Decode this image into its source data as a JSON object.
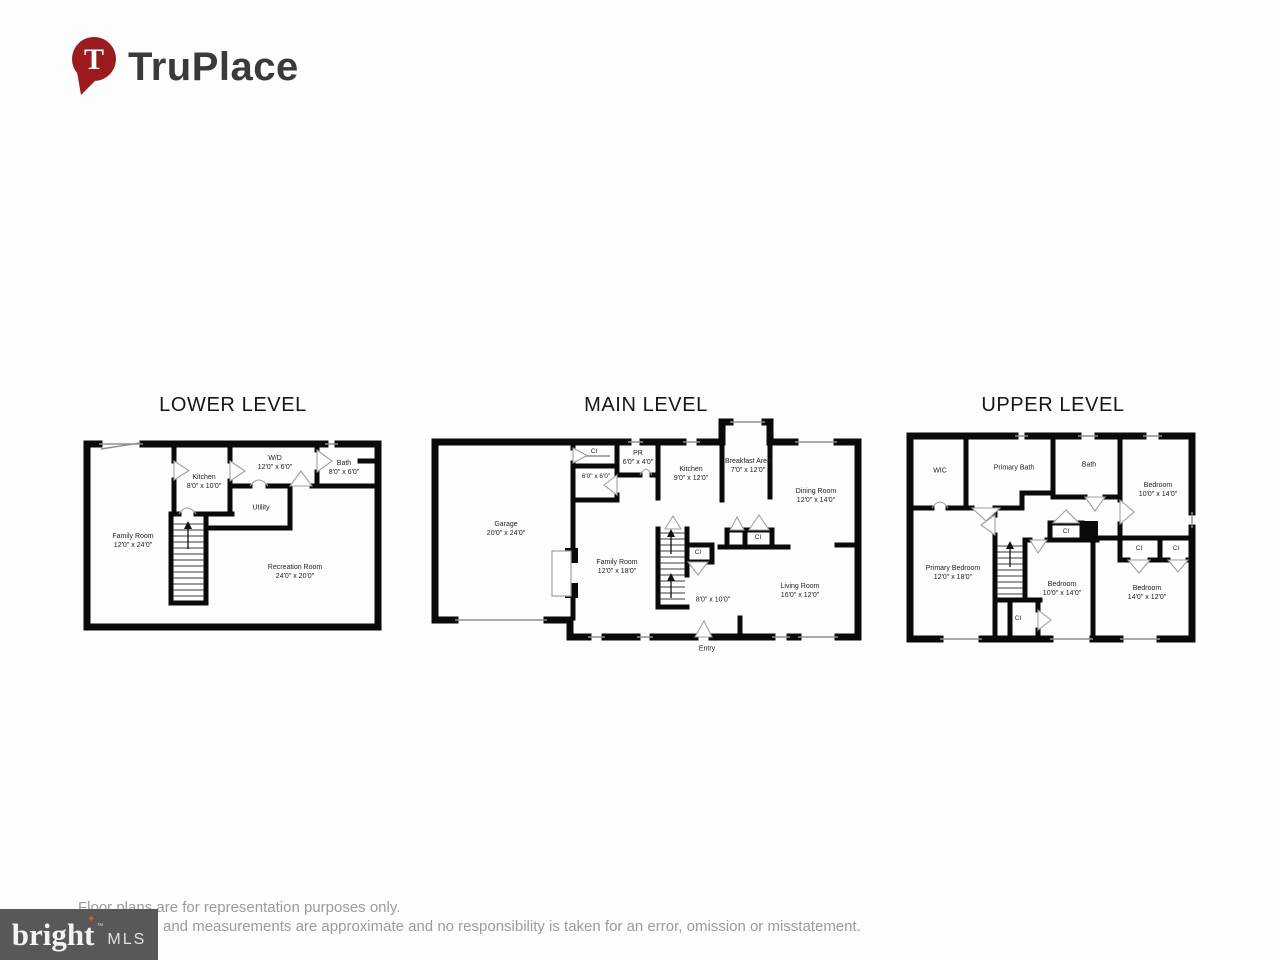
{
  "brand": {
    "name": "TruPlace",
    "pin_letter": "T"
  },
  "plans": {
    "lower": {
      "title": "LOWER LEVEL",
      "rooms": {
        "family": {
          "name": "Family Room",
          "dims": "12'0\" x 24'0\""
        },
        "kitchen": {
          "name": "Kitchen",
          "dims": "8'0\" x 10'0\""
        },
        "wd": {
          "name": "W/D",
          "dims": "12'0\" x 6'0\""
        },
        "bath": {
          "name": "Bath",
          "dims": "8'0\" x 6'0\""
        },
        "utility": {
          "name": "Utility"
        },
        "recreation": {
          "name": "Recreation Room",
          "dims": "24'0\" x 20'0\""
        }
      }
    },
    "main": {
      "title": "MAIN LEVEL",
      "rooms": {
        "garage": {
          "name": "Garage",
          "dims": "20'0\" x 24'0\""
        },
        "closet_top": {
          "name": "CI"
        },
        "mudroom": {
          "dims": "6'0\" x 6'0\""
        },
        "powder": {
          "name": "PR",
          "dims": "6'0\" x 4'0\""
        },
        "kitchen": {
          "name": "Kitchen",
          "dims": "9'0\" x 12'0\""
        },
        "breakfast": {
          "name": "Breakfast Area",
          "dims": "7'0\" x 12'0\""
        },
        "dining": {
          "name": "Dining Room",
          "dims": "12'0\" x 14'0\""
        },
        "family": {
          "name": "Family Room",
          "dims": "12'0\" x 18'0\""
        },
        "stairs": {
          "dims": "8'0\" x 10'0\""
        },
        "closet_stairs": {
          "name": "CI"
        },
        "closet_hall": {
          "name": "CI"
        },
        "living": {
          "name": "Living Room",
          "dims": "16'0\" x 12'0\""
        },
        "entry": {
          "name": "Entry"
        }
      }
    },
    "upper": {
      "title": "UPPER LEVEL",
      "rooms": {
        "wic": {
          "name": "WIC"
        },
        "primary_bath": {
          "name": "Primary Bath"
        },
        "bath": {
          "name": "Bath"
        },
        "bedroom_tr": {
          "name": "Bedroom",
          "dims": "10'0\" x 14'0\""
        },
        "primary_bedroom": {
          "name": "Primary Bedroom",
          "dims": "12'0\" x 18'0\""
        },
        "bedroom_mid": {
          "name": "Bedroom",
          "dims": "10'0\" x 14'0\""
        },
        "bedroom_br": {
          "name": "Bedroom",
          "dims": "14'0\" x 12'0\""
        },
        "closet_hall": {
          "name": "CI"
        },
        "closet_tr1": {
          "name": "CI"
        },
        "closet_tr2": {
          "name": "CI"
        },
        "closet_stairs": {
          "name": "CI"
        }
      }
    }
  },
  "footer": {
    "line1": "Floor plans are for representation purposes only.",
    "line2": "and measurements are approximate and no responsibility is taken for an error, omission or misstatement."
  },
  "mls": {
    "brand": "bright",
    "tm": "™",
    "suffix": "MLS",
    "star": "✦"
  },
  "colors": {
    "pin_red": "#9b1b1f",
    "wall": "#0a0a0a",
    "muted_text": "#9b9b9b"
  }
}
